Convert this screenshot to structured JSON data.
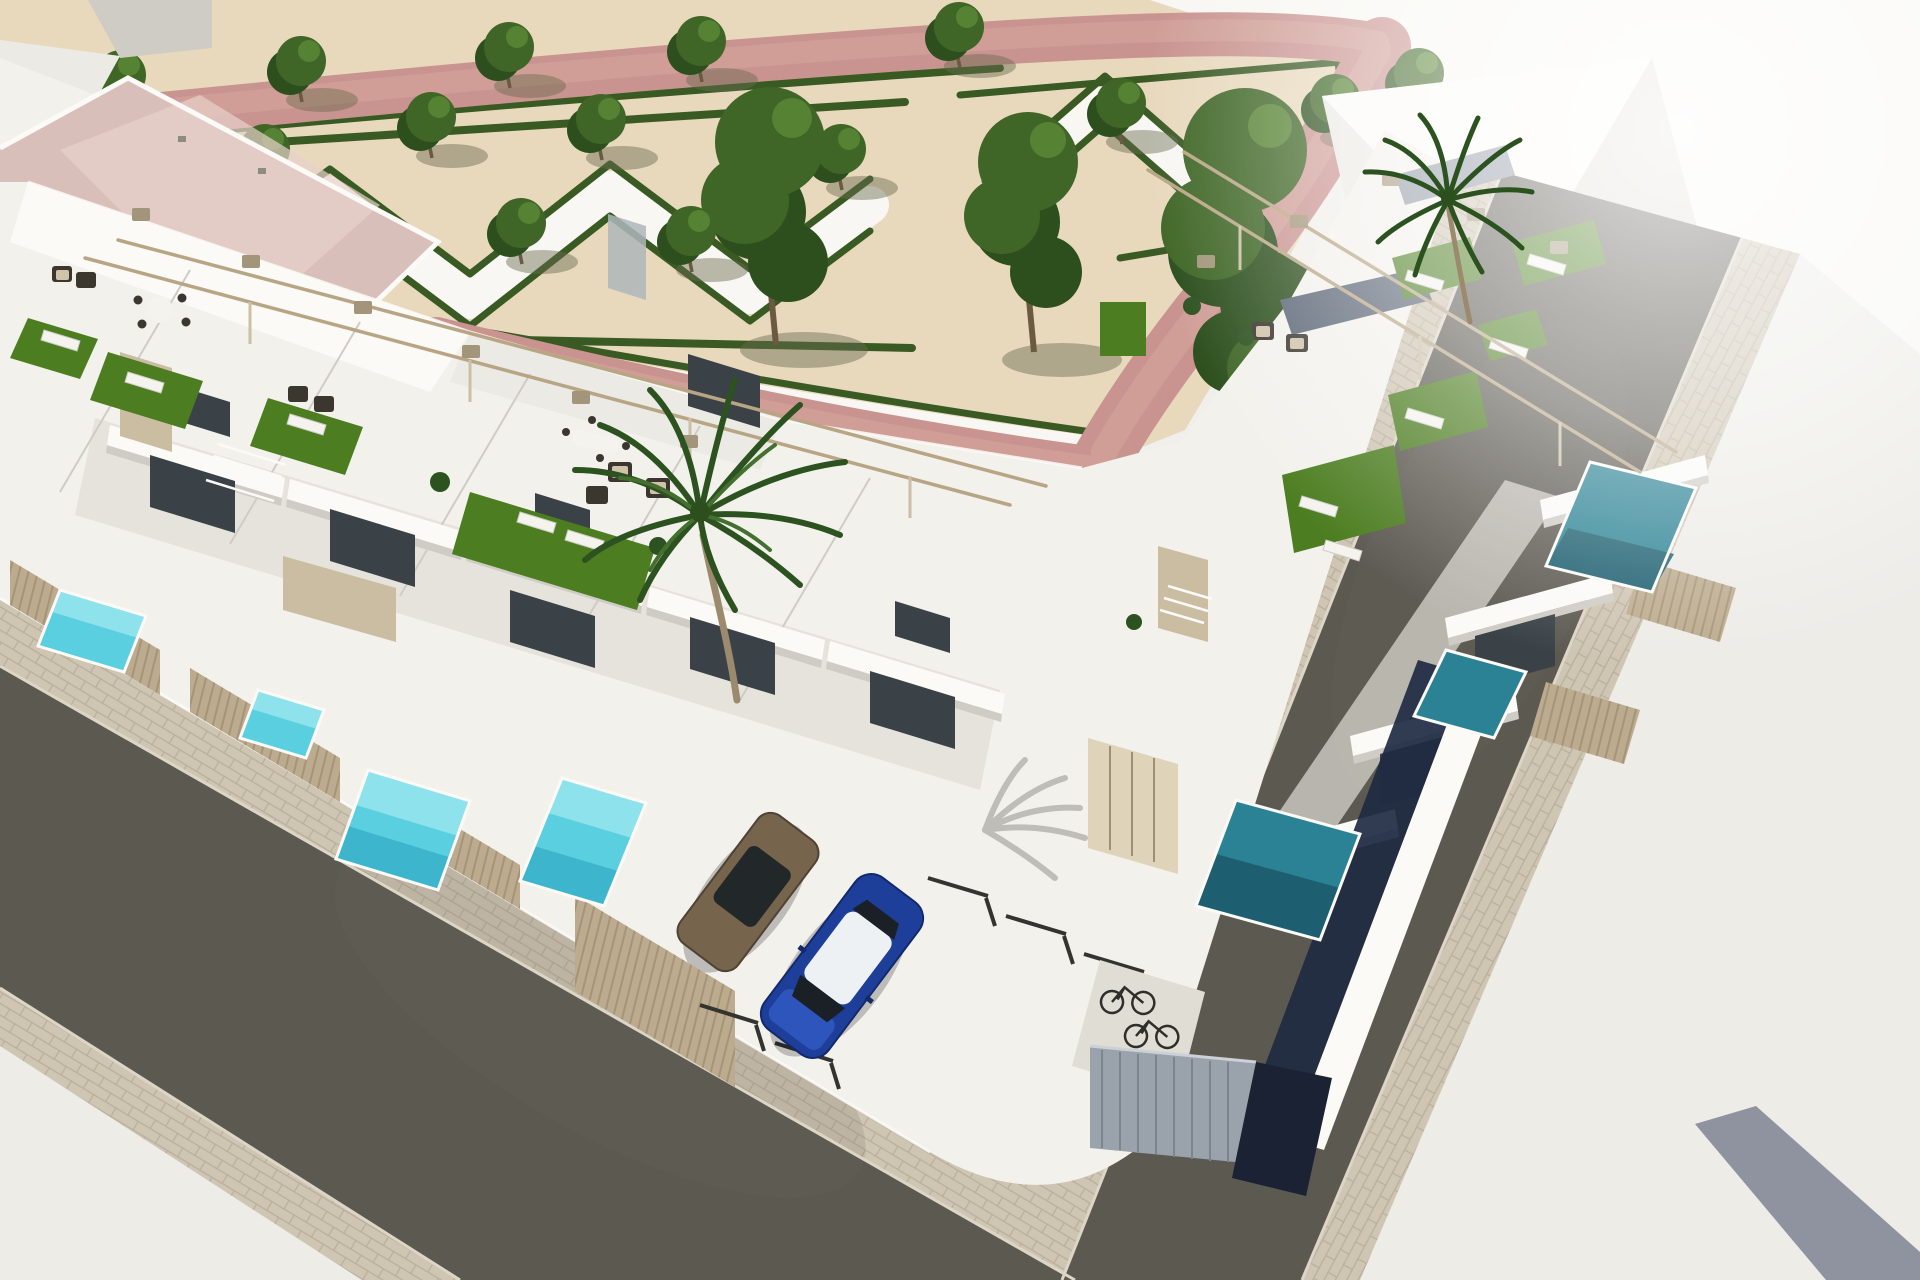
{
  "scene": {
    "type": "architectural-aerial-render",
    "description": "Aerial 3D architectural rendering of a modern white townhouse development on a street corner: rooftop terraces with artificial turf, sun loungers and pergolas, private plunge pools, a landscaped park with geometric hedge parterres and trees, two streets with paver sidewalks, a parking court with two cars, bicycles and a corner bike shelter.",
    "objects": [
      "townhouse-complex",
      "rooftop-terraces",
      "pergolas",
      "sun-loungers",
      "outdoor-sofas",
      "private-pools",
      "hedge-park",
      "trees",
      "palm-trees",
      "pink-walking-paths",
      "streets",
      "paver-sidewalks",
      "parking-court",
      "blue-car",
      "brown-car",
      "bicycles",
      "bike-shelter",
      "garage-doors",
      "slat-fences"
    ],
    "counts": {
      "bright_pools": 4,
      "shaded_pools": 3,
      "cars": 2,
      "bicycles": 3,
      "palm_trees": 2,
      "large_trees": 3,
      "small_trees": 17
    }
  },
  "colors": {
    "base": "#f0efeb",
    "sand": "#e8d9bd",
    "plaza": "#f8f7f3",
    "pale_ground": "#edece7",
    "path_pink": "#c9938f",
    "path_pink_light": "#d6a79e",
    "hedge": "#3a5a24",
    "tree": "#3f6626",
    "tree_dark": "#2c4f1d",
    "tree_light": "#5b8836",
    "trunk": "#6b5940",
    "shadow_olive": "#6b6a4f",
    "roof_pink": "#d9bfba",
    "roof_pink_light": "#e7d1ca",
    "wall_white": "#f3f1ec",
    "wall_bright": "#fbfaf7",
    "wall_light": "#eceae4",
    "wall_shade": "#e0ddd5",
    "wall_deep": "#cfccc5",
    "glass_dark": "#3a4247",
    "glass_gray": "#aeb6ba",
    "slate_roof": "#5a6575",
    "slate_light": "#8e97a4",
    "navy_shadow": "#1f2a42",
    "turf": "#4c7d20",
    "lounger": "#f4f3ee",
    "furn_dark": "#3b362e",
    "cushion": "#cfc3aa",
    "pergola": "#b7a584",
    "pergola_cap": "#a2957a",
    "post": "#cbc0a6",
    "fence": "#bcab8e",
    "fence_line": "#9f8f73",
    "stone": "#cabda2",
    "garage": "#dfd3ba",
    "pool_bright": "#5acfe0",
    "pool_bright_hi": "#a9edf2",
    "pool_bright_deep": "#2fa9c5",
    "pool_teal": "#2b8294",
    "pool_teal_deep": "#1d5f70",
    "asphalt": "#5c5951",
    "asphalt_light": "#6a675f",
    "paver": "#cfc5b3",
    "paver_line": "#b9ae9b",
    "curb": "#ddd5c6",
    "divider": "#33332f",
    "car_blue": "#1d3f9a",
    "car_blue_dark": "#14296b",
    "car_blue_light": "#2e55bb",
    "car_roof": "#eef1f4",
    "car_glass": "#1a2026",
    "car_brown": "#76644c",
    "car_brown_dark": "#4e4334",
    "bike": "#2e2e2a",
    "shed": "#9aa2ac",
    "shed_line": "#7c848e",
    "shed_top": "#ccd1d7",
    "shed_navy": "#1a2233",
    "palm_green": "#2c5220",
    "palm_light": "#43702e",
    "palm_trunk": "#9b8a6d",
    "slate_strip": "#8f93a0",
    "shadow_wall": "#8c8b84",
    "glow": "#ffffff"
  }
}
